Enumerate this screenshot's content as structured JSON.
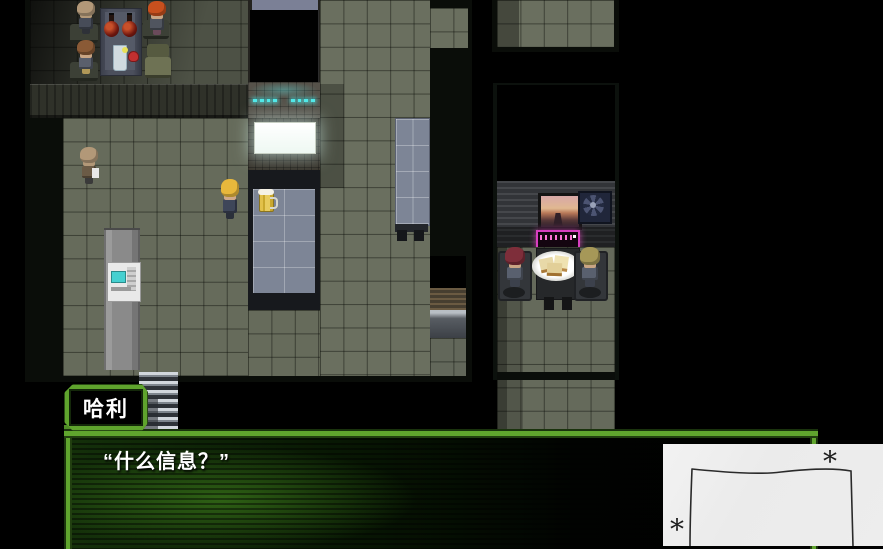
{
  "scene": {
    "type": "rpg-top-down-map",
    "setting": "dark sci-fi bar interior"
  },
  "palette": {
    "accent_green": "#5fa42d",
    "accent_green_dark": "#1a330d",
    "floor_olive": "#6a6f5f",
    "table_blue": "#7d8596",
    "led_cyan": "#52e8e8",
    "sign_white": "#fafffb",
    "neon_pink": "#d83fc0",
    "beer_yellow": "#e2c14a",
    "overlay_paper": "#ededed"
  },
  "ui": {
    "name_box": {
      "label": "哈利"
    },
    "dialog": {
      "text": "“什么信息？”"
    }
  },
  "overlay": {
    "asterisk_top": "*",
    "asterisk_bottom": "*"
  },
  "map": {
    "objects": [
      "bar-table-with-bottles",
      "counter-led-strip",
      "glowing-menu-sign",
      "blue-bar-counter",
      "beer-mug",
      "wall-blue-panel",
      "sliding-door",
      "ticket-machine",
      "staircase",
      "picture-frame",
      "ventilation-fan",
      "pink-neon-sign",
      "dining-table",
      "sandwich-plate"
    ],
    "entities": [
      {
        "name": "npc-bald-patron",
        "x": 75,
        "y": 1,
        "w": 22,
        "h": 37,
        "skin": "#b29878",
        "hair": null,
        "body": "#474c58",
        "pants": "#2e3138"
      },
      {
        "name": "npc-brown-hair-patron",
        "x": 75,
        "y": 40,
        "w": 22,
        "h": 38,
        "skin": "#c9a584",
        "hair": "#8a5a36",
        "body": "#5a5f6c",
        "pants": "#b09858"
      },
      {
        "name": "npc-red-hair-patron",
        "x": 146,
        "y": 1,
        "w": 22,
        "h": 38,
        "skin": "#c9a584",
        "hair": "#c8501e",
        "body": "#50555f",
        "pants": "#6a4a5a"
      },
      {
        "name": "npc-bald-civilian",
        "x": 78,
        "y": 147,
        "w": 22,
        "h": 41,
        "skin": "#b29878",
        "hair": null,
        "body": "#6b5b46",
        "pants": "#3a3a3a"
      },
      {
        "name": "player-blonde",
        "x": 219,
        "y": 179,
        "w": 22,
        "h": 44,
        "skin": "#cfa98a",
        "hair": "#e8b83c",
        "body": "#3e4659",
        "pants": "#2a2f3a"
      },
      {
        "name": "npc-maroon-hair-diner",
        "x": 503,
        "y": 247,
        "w": 24,
        "h": 44,
        "skin": "#c9a584",
        "hair": "#7e2e3a",
        "body": "#59606e",
        "pants": "#3c414c"
      },
      {
        "name": "npc-olive-blonde-diner",
        "x": 578,
        "y": 247,
        "w": 24,
        "h": 44,
        "skin": "#c9a584",
        "hair": "#a69858",
        "body": "#59606e",
        "pants": "#3c414c"
      }
    ]
  }
}
